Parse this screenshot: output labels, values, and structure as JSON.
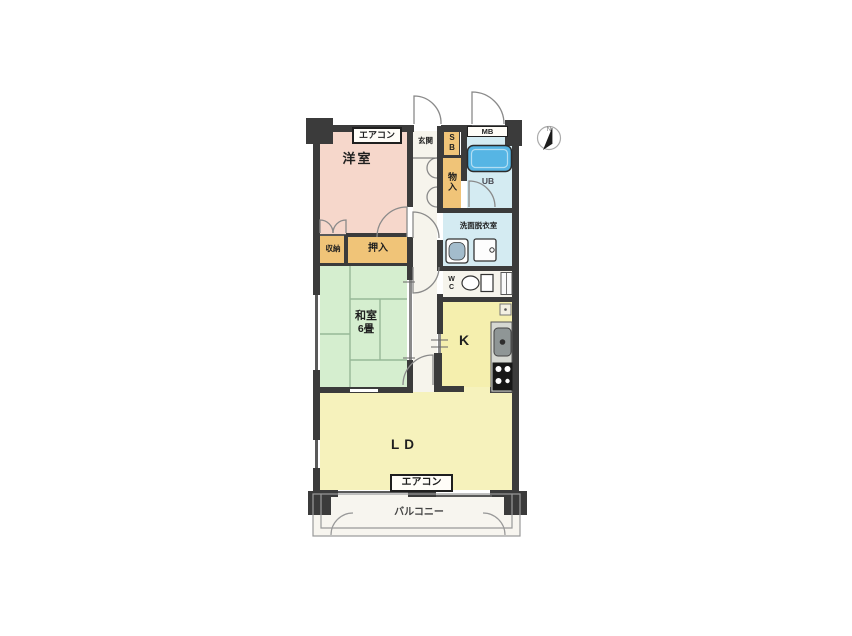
{
  "rooms": {
    "western_room": {
      "label": "洋室"
    },
    "japanese_room": {
      "label": "和室",
      "size": "6畳"
    },
    "living_dining": {
      "label": "LD"
    },
    "kitchen": {
      "label": "K"
    },
    "entrance": {
      "label": "玄関"
    },
    "shoe_box": {
      "label": "SB"
    },
    "meter_box": {
      "label": "MB"
    },
    "storage": {
      "label": "物入"
    },
    "unit_bath": {
      "label": "UB"
    },
    "washroom": {
      "label": "洗面脱衣室"
    },
    "toilet": {
      "label": "WC"
    },
    "closet_oshiire": {
      "label": "押入"
    },
    "closet_shuno": {
      "label": "収納"
    },
    "balcony": {
      "label": "バルコニー"
    }
  },
  "equipment": {
    "aircon_label": "エアコン"
  },
  "compass": {
    "north": "N"
  },
  "colors": {
    "wall": "#3b3b3b",
    "western_room": "#f6d7cb",
    "japanese_room": "#d5eecf",
    "closet": "#f0c478",
    "bath": "#d4ebf2",
    "bathtub": "#56b5e4",
    "kitchen": "#f5efae",
    "living_dining": "#f6f2bc",
    "hall": "#f6f4ec"
  }
}
